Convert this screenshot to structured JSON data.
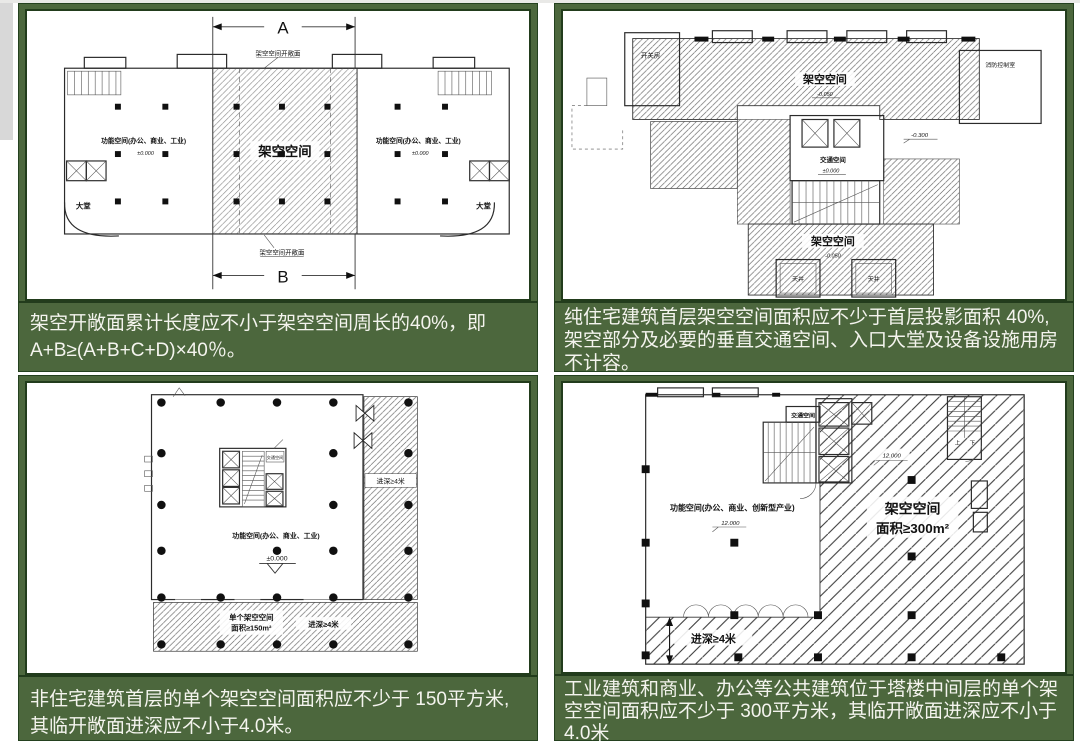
{
  "page": {
    "cell_green": "#4c673d",
    "border_green": "#24411f",
    "sidebar_gray": "#d8d8d8",
    "caption_text_color": "#f4f4ee"
  },
  "cells": {
    "top_left": {
      "caption": [
        "架空开敞面累计长度应不小于架空空间周长的40%，即",
        "A+B≥(A+B+C+D)×40％。"
      ],
      "plan": {
        "dim_top": "A",
        "dim_bottom": "B",
        "open_edge_top": "架空空间开敞面",
        "open_edge_bottom": "架空空间开敞面",
        "stilt_space": "架空空间",
        "func_left": "功能空间(办公、商业、工业)",
        "func_right": "功能空间(办公、商业、工业)",
        "level_left": "±0.000",
        "level_right": "±0.000",
        "lobby_left": "大堂",
        "lobby_right": "大堂"
      }
    },
    "top_right": {
      "caption": [
        "纯住宅建筑首层架空空间面积应不少于首层投影面积 40%,",
        "架空部分及必要的垂直交通空间、入口大堂及设备设施用房",
        "不计容。"
      ],
      "plan": {
        "switch_room": "开关房",
        "fire_control_room": "消防控制室",
        "stilt_top": "架空空间",
        "level_top": "-0.050",
        "traffic_space": "交通空间",
        "level_core": "±0.000",
        "level_right": "-0.300",
        "stilt_bottom": "架空空间",
        "level_bottom": "-0.050",
        "lightwell_left": "天井",
        "lightwell_right": "天井"
      }
    },
    "bottom_left": {
      "caption": [
        "非住宅建筑首层的单个架空空间面积应不少于 150平方米,",
        "其临开敞面进深应不小于4.0米。"
      ],
      "plan": {
        "traffic_space": "交通空间",
        "func": "功能空间(办公、商业、工业)",
        "level": "±0.000",
        "depth_right": "进深≥4米",
        "stilt_line1": "单个架空空间",
        "stilt_line2": "面积≥150m²",
        "depth_bottom": "进深≥4米"
      }
    },
    "bottom_right": {
      "caption": [
        "工业建筑和商业、办公等公共建筑位于塔楼中间层的单个架",
        "空空间面积应不少于 300平方米，其临开敞面进深应不小于",
        "4.0米"
      ],
      "plan": {
        "traffic_space": "交通空间",
        "func": "功能空间(办公、商业、创新型产业)",
        "level_func": "12.000",
        "level_stilt": "12.000",
        "stilt_line1": "架空空间",
        "stilt_line2": "面积≥300m²",
        "depth": "进深≥4米",
        "up": "上",
        "down": "下"
      }
    }
  }
}
